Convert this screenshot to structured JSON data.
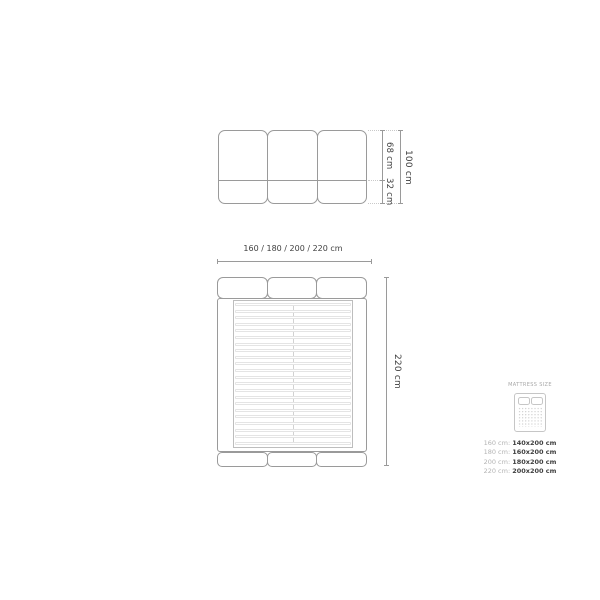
{
  "headboard_view": {
    "dim_upper": "68 cm",
    "dim_lower": "32 cm",
    "dim_total": "100 cm"
  },
  "bed_view": {
    "dim_width": "160 / 180 / 200 / 220 cm",
    "dim_length": "220 cm",
    "slat_count": 22
  },
  "legend": {
    "title": "MATTRESS SIZE",
    "rows": [
      {
        "bed": "160 cm:",
        "mattress": "140x200 cm"
      },
      {
        "bed": "180 cm:",
        "mattress": "160x200 cm"
      },
      {
        "bed": "200 cm:",
        "mattress": "180x200 cm"
      },
      {
        "bed": "220 cm:",
        "mattress": "200x200 cm"
      }
    ]
  },
  "colors": {
    "outline": "#9a9a9a",
    "innerline": "#bdbdbd",
    "slat": "#e4e4e4",
    "rail": "#d2d2d2",
    "dotted": "#c9c9c9",
    "text": "#3f3f3f",
    "legendlight": "#b3b3b3",
    "legendicon": "#c6c6c6",
    "legendtitle": "#a8a8a8"
  }
}
